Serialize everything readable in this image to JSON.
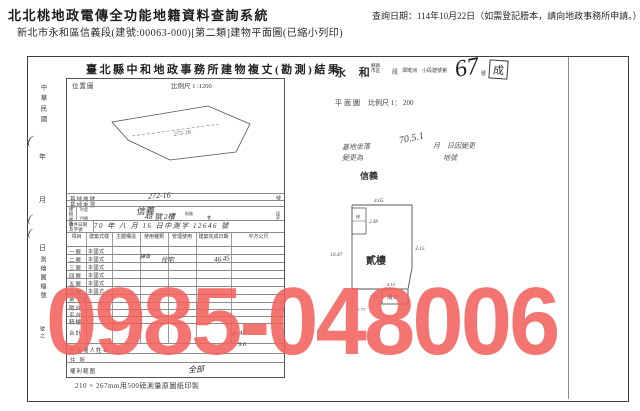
{
  "header": {
    "system_title": "北北桃地政電傳全功能地籍資料查詢系統",
    "query_date_note": "查詢日期：114年10月22日（如需登記謄本，請向地政事務所申請。）",
    "document_subtitle": "新北市永和區信義段(建號:00063-000)[第二類]建物平面圖(已縮小列印)"
  },
  "watermark": {
    "phone": "0985-048006",
    "color": "rgba(242,95,92,0.87)"
  },
  "scan": {
    "form_title": "臺北縣中和地政事務所建物複丈(勘測)結果",
    "margin": {
      "era": "中華民國",
      "year": "年",
      "month": "月",
      "day": "日",
      "paren1": "(",
      "paren2": "(",
      "paren3": "(",
      "sheet_label": "測繪圖幅號",
      "sheet_no": "號之"
    },
    "location_map": {
      "label": "位置圖",
      "scale": "比例尺 1 :1200",
      "parcel_note": "272-16"
    },
    "site": {
      "land_no_label": "基地地號",
      "land_no_value": "272-16",
      "land_no_suffix": "號",
      "land_source_label": "基地來源",
      "situs_label": "建物坐落",
      "village_label": "村里",
      "street_label": "街路",
      "street_hand": "信義",
      "street_suffix": "段",
      "lane_label": "巷",
      "alley_label": "弄",
      "door_label": "門牌",
      "door_value": "48 號 2樓"
    },
    "receipt": {
      "label": "收件日期及字號",
      "value": "70 年 八 月 16 日中測字 12646 號"
    },
    "floor_table": {
      "headers": [
        "項目",
        "建築式樣",
        "主體構造",
        "使用種類",
        "管理使用",
        "建築完成日期",
        "平方公尺"
      ],
      "rows": [
        {
          "label": "一層",
          "style": "本國式"
        },
        {
          "label": "二層",
          "style": "本國式"
        },
        {
          "label": "三層",
          "style": "本國式"
        },
        {
          "label": "四層",
          "style": "本國式"
        },
        {
          "label": "五層",
          "style": "本國式"
        },
        {
          "label": "六層",
          "style": "本國式"
        },
        {
          "label": "地下室",
          "style": ""
        },
        {
          "label": "陽台",
          "style": ""
        },
        {
          "label": "平台",
          "style": ""
        },
        {
          "label": "騎樓",
          "style": ""
        },
        {
          "label": "合計",
          "style": ""
        }
      ]
    },
    "handwriting": {
      "structure": "磚造",
      "use": "住宅",
      "area_2f": "46.45",
      "total_1": "46.45",
      "total_2": "9.6",
      "rights": "全部"
    },
    "owner": {
      "name_label": "所有權人姓名",
      "address_label": "住所",
      "rights_label": "權利範圍"
    },
    "paper_note": "210 × 267mm用500磅測量原圖紙印製",
    "plan_header": {
      "town": "永 和",
      "town_unit": "鄉鎮市區",
      "section_suffix": "段",
      "subsection": "潭墘洲",
      "subsection_suffix": "小段建號第",
      "building_no_hand": "67",
      "no_suffix": "號",
      "stamp": "成"
    },
    "plan_scale": {
      "label": "平面圖",
      "scale": "比例尺 1： 200"
    },
    "plan_annotations": {
      "line1a": "基地坐落",
      "line1b": "70.5.1",
      "line1c": "月　日因變更",
      "line2a": "變更為",
      "line2b": "地號",
      "stamp": "信義"
    },
    "plan": {
      "floor_label": "貳樓",
      "balcony_label": "陽台",
      "stair_label": "梯",
      "dim_top": "4.65",
      "dim_stair": "2.48",
      "dim_right": "3.15",
      "dim_left": "10.47",
      "dim_balcony_top": "4.10",
      "dim_balcony_left": "1.70",
      "dim_balcony_bottom": "1.73"
    }
  }
}
